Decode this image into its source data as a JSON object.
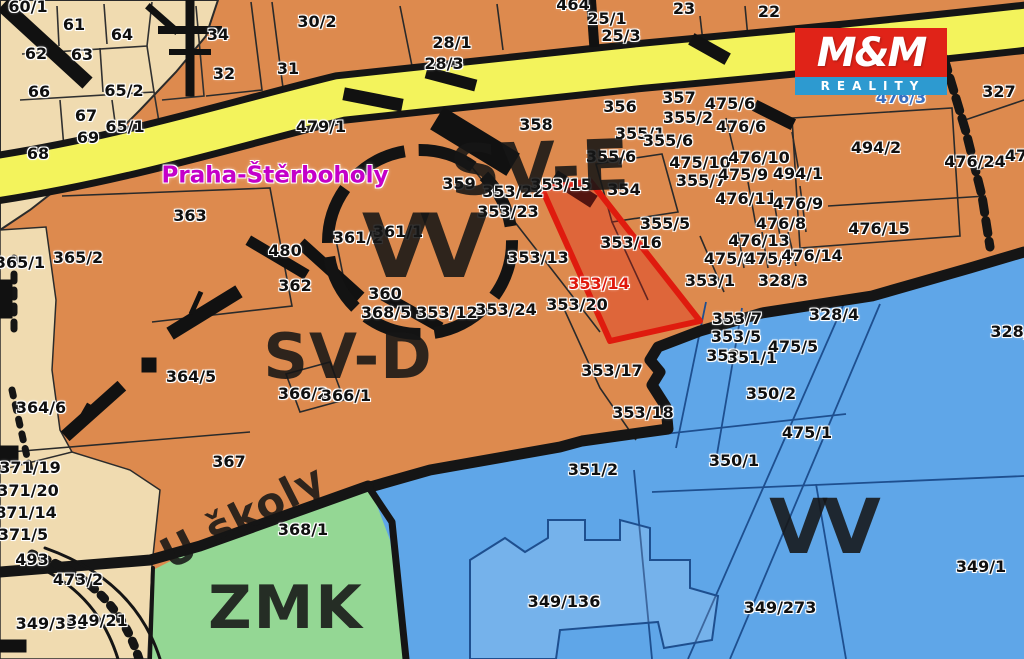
{
  "map": {
    "region_label": {
      "text": "Praha-Štěrboholy",
      "x": 275,
      "y": 176
    },
    "highlighted_parcel": "353/14",
    "zone_labels": [
      {
        "t": "SV-E",
        "x": 540,
        "y": 168,
        "s": 70,
        "rot": -2
      },
      {
        "t": "VV",
        "x": 420,
        "y": 247,
        "s": 88,
        "ls": -10
      },
      {
        "t": "SV-D",
        "x": 348,
        "y": 357,
        "s": 62
      },
      {
        "t": "ZMK",
        "x": 286,
        "y": 608,
        "s": 60,
        "ls": 2
      },
      {
        "t": "VV",
        "x": 822,
        "y": 527,
        "s": 76,
        "ls": -6
      }
    ],
    "street_labels": [
      {
        "t": "U školy",
        "x": 243,
        "y": 517,
        "s": 42,
        "rot": -27
      }
    ],
    "parcel_labels": [
      {
        "t": "60/1",
        "x": 28,
        "y": 7
      },
      {
        "t": "61",
        "x": 74,
        "y": 25
      },
      {
        "t": "64",
        "x": 122,
        "y": 35
      },
      {
        "t": "62",
        "x": 36,
        "y": 54
      },
      {
        "t": "63",
        "x": 82,
        "y": 55
      },
      {
        "t": "66",
        "x": 39,
        "y": 92
      },
      {
        "t": "65/2",
        "x": 124,
        "y": 91
      },
      {
        "t": "67",
        "x": 86,
        "y": 116
      },
      {
        "t": "65/1",
        "x": 125,
        "y": 127
      },
      {
        "t": "69",
        "x": 88,
        "y": 138
      },
      {
        "t": "68",
        "x": 38,
        "y": 154
      },
      {
        "t": "34",
        "x": 218,
        "y": 35
      },
      {
        "t": "32",
        "x": 224,
        "y": 74
      },
      {
        "t": "30/2",
        "x": 317,
        "y": 22
      },
      {
        "t": "31",
        "x": 288,
        "y": 69
      },
      {
        "t": "28/1",
        "x": 452,
        "y": 43
      },
      {
        "t": "28/3",
        "x": 444,
        "y": 64
      },
      {
        "t": "464",
        "x": 573,
        "y": 5
      },
      {
        "t": "25/1",
        "x": 607,
        "y": 19
      },
      {
        "t": "25/3",
        "x": 621,
        "y": 36
      },
      {
        "t": "23",
        "x": 684,
        "y": 9
      },
      {
        "t": "22",
        "x": 769,
        "y": 12
      },
      {
        "t": "479/1",
        "x": 321,
        "y": 127
      },
      {
        "t": "356",
        "x": 620,
        "y": 107
      },
      {
        "t": "357",
        "x": 679,
        "y": 98
      },
      {
        "t": "355/2",
        "x": 688,
        "y": 118
      },
      {
        "t": "475/6",
        "x": 730,
        "y": 104
      },
      {
        "t": "476/6",
        "x": 741,
        "y": 127
      },
      {
        "t": "355/1",
        "x": 640,
        "y": 134
      },
      {
        "t": "355/6",
        "x": 668,
        "y": 141
      },
      {
        "t": "355/6",
        "x": 611,
        "y": 157
      },
      {
        "t": "475/10",
        "x": 700,
        "y": 163
      },
      {
        "t": "476/10",
        "x": 759,
        "y": 158
      },
      {
        "t": "355/7",
        "x": 701,
        "y": 181
      },
      {
        "t": "475/9",
        "x": 743,
        "y": 175
      },
      {
        "t": "494/1",
        "x": 798,
        "y": 174
      },
      {
        "t": "494/2",
        "x": 876,
        "y": 148
      },
      {
        "t": "358",
        "x": 536,
        "y": 125
      },
      {
        "t": "359",
        "x": 459,
        "y": 184
      },
      {
        "t": "353/22",
        "x": 513,
        "y": 192
      },
      {
        "t": "353/23",
        "x": 508,
        "y": 212
      },
      {
        "t": "353/15",
        "x": 561,
        "y": 185
      },
      {
        "t": "354",
        "x": 624,
        "y": 190
      },
      {
        "t": "355/5",
        "x": 665,
        "y": 224
      },
      {
        "t": "353/16",
        "x": 631,
        "y": 243
      },
      {
        "t": "353/13",
        "x": 538,
        "y": 258
      },
      {
        "t": "353/14",
        "x": 599,
        "y": 284,
        "c": "red"
      },
      {
        "t": "353/1",
        "x": 710,
        "y": 281
      },
      {
        "t": "328/3",
        "x": 783,
        "y": 281
      },
      {
        "t": "476/11",
        "x": 746,
        "y": 199
      },
      {
        "t": "476/9",
        "x": 798,
        "y": 204
      },
      {
        "t": "476/8",
        "x": 781,
        "y": 224
      },
      {
        "t": "476/13",
        "x": 759,
        "y": 241
      },
      {
        "t": "475/8",
        "x": 729,
        "y": 259
      },
      {
        "t": "475/7",
        "x": 770,
        "y": 259
      },
      {
        "t": "476/14",
        "x": 812,
        "y": 256
      },
      {
        "t": "476/15",
        "x": 879,
        "y": 229
      },
      {
        "t": "476/24",
        "x": 975,
        "y": 162
      },
      {
        "t": "47",
        "x": 1016,
        "y": 156
      },
      {
        "t": "327",
        "x": 999,
        "y": 92
      },
      {
        "t": "476/3",
        "x": 901,
        "y": 98,
        "c": "blue"
      },
      {
        "t": "363",
        "x": 190,
        "y": 216
      },
      {
        "t": "480",
        "x": 285,
        "y": 251
      },
      {
        "t": "361/2",
        "x": 358,
        "y": 238
      },
      {
        "t": "361/1",
        "x": 398,
        "y": 232
      },
      {
        "t": "362",
        "x": 295,
        "y": 286
      },
      {
        "t": "360",
        "x": 385,
        "y": 294
      },
      {
        "t": "368/5",
        "x": 386,
        "y": 313
      },
      {
        "t": "353/12",
        "x": 447,
        "y": 313
      },
      {
        "t": "353/24",
        "x": 506,
        "y": 310
      },
      {
        "t": "353/20",
        "x": 577,
        "y": 305
      },
      {
        "t": "353/17",
        "x": 612,
        "y": 371
      },
      {
        "t": "353/18",
        "x": 643,
        "y": 413
      },
      {
        "t": "353/7",
        "x": 737,
        "y": 319
      },
      {
        "t": "353/5",
        "x": 736,
        "y": 337
      },
      {
        "t": "352",
        "x": 723,
        "y": 356
      },
      {
        "t": "351/1",
        "x": 752,
        "y": 358
      },
      {
        "t": "475/5",
        "x": 793,
        "y": 347
      },
      {
        "t": "328/4",
        "x": 834,
        "y": 315
      },
      {
        "t": "350/2",
        "x": 771,
        "y": 394
      },
      {
        "t": "475/1",
        "x": 807,
        "y": 433
      },
      {
        "t": "350/1",
        "x": 734,
        "y": 461
      },
      {
        "t": "351/2",
        "x": 593,
        "y": 470
      },
      {
        "t": "365/1",
        "x": 20,
        "y": 263
      },
      {
        "t": "365/2",
        "x": 78,
        "y": 258
      },
      {
        "t": "364/5",
        "x": 191,
        "y": 377
      },
      {
        "t": "364/6",
        "x": 41,
        "y": 408
      },
      {
        "t": "367",
        "x": 229,
        "y": 462
      },
      {
        "t": "366/2",
        "x": 303,
        "y": 394
      },
      {
        "t": "366/1",
        "x": 346,
        "y": 396
      },
      {
        "t": "371/19",
        "x": 30,
        "y": 468
      },
      {
        "t": "371/20",
        "x": 28,
        "y": 491
      },
      {
        "t": "871/14",
        "x": 26,
        "y": 513
      },
      {
        "t": "371/5",
        "x": 23,
        "y": 535
      },
      {
        "t": "493",
        "x": 32,
        "y": 560
      },
      {
        "t": "473/2",
        "x": 78,
        "y": 580
      },
      {
        "t": "349/355",
        "x": 52,
        "y": 624
      },
      {
        "t": "349/21",
        "x": 97,
        "y": 621
      },
      {
        "t": "368/1",
        "x": 303,
        "y": 530
      },
      {
        "t": "349/136",
        "x": 564,
        "y": 602
      },
      {
        "t": "349/273",
        "x": 780,
        "y": 608
      },
      {
        "t": "349/1",
        "x": 981,
        "y": 567
      },
      {
        "t": "328/",
        "x": 1010,
        "y": 332
      }
    ]
  },
  "logo": {
    "top": "M&M",
    "bottom": "REALITY"
  },
  "colors": {
    "orange_zone": "#dd8a4e",
    "beige_zone": "#f0dbb0",
    "yellow_road": "#f3f35c",
    "green_zone": "#94d794",
    "blue_zone": "#5fa6e8",
    "highlight_stroke": "#df1b0e",
    "red_text": "#e0190c",
    "blue_text": "#3a6fc0",
    "magenta": "#c400c9",
    "logo_red": "#e02318",
    "logo_blue": "#2d9ad0",
    "boundary_black": "#151515"
  }
}
